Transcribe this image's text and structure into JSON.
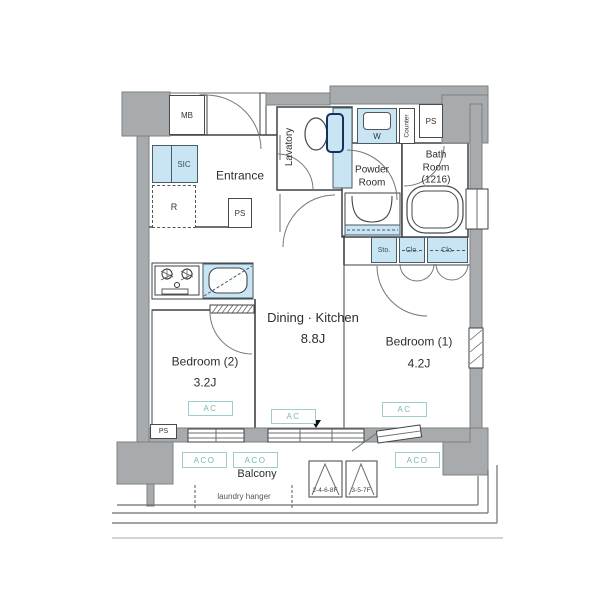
{
  "plan": {
    "colors": {
      "wall_gray": "#a8abad",
      "wall_edge": "#7d8082",
      "line": "#3f4245",
      "line2": "#6b6e70",
      "fixture_blue": "#c9e4f2",
      "teal": "#9ccccb",
      "teal_text": "#7ab5b5",
      "blue_text": "#33525f"
    },
    "rooms": {
      "entrance": "Entrance",
      "lavatory": "Lavatory",
      "powder_room": "Powder Room",
      "bath_room": "Bath Room",
      "bath_room_size": "(1216)",
      "dining_kitchen": "Dining · Kitchen",
      "dining_kitchen_size": "8.8J",
      "bedroom1": "Bedroom (1)",
      "bedroom1_size": "4.2J",
      "bedroom2": "Bedroom (2)",
      "bedroom2_size": "3.2J",
      "balcony": "Balcony"
    },
    "small_labels": {
      "mb": "MB",
      "sic": "SIC",
      "r": "R",
      "ps": "PS",
      "w": "W",
      "counter": "Counter",
      "sto": "Sto.",
      "clo": "Clo.",
      "ac": "AC",
      "aco": "ACO",
      "laundry_hanger": "laundry hanger",
      "floors_even": "2-4-6-8F",
      "floors_odd": "3-5-7F"
    }
  }
}
